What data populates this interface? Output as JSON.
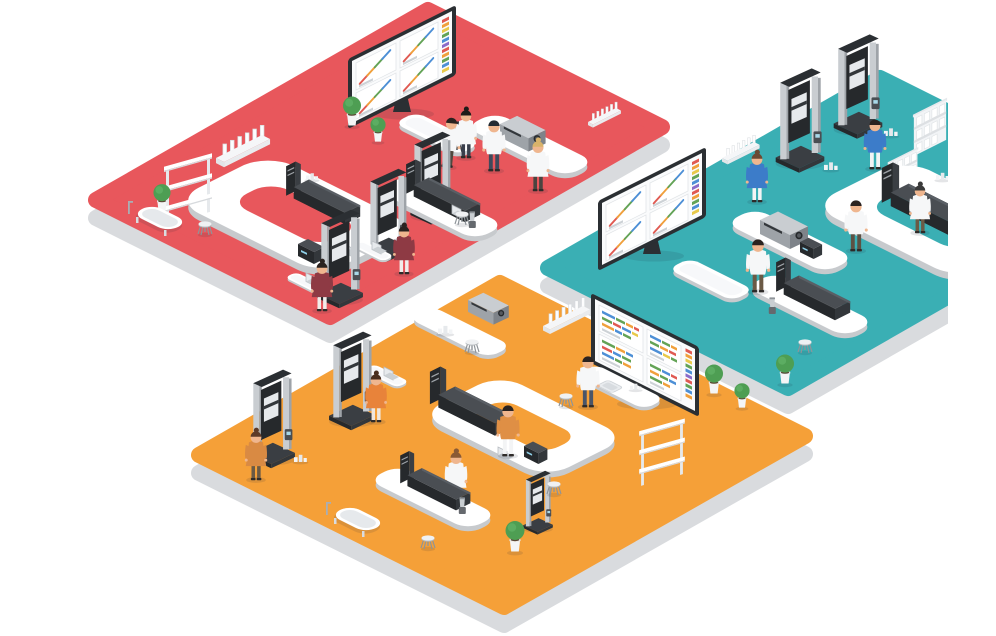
{
  "scene": {
    "title": "Isometric laboratory rooms illustration",
    "subtitle": "Three color-coded testing laboratories with scientists, analysis machines and presentation screens",
    "background_color": "#FFFFFF",
    "style": "flat isometric vector illustration",
    "no_visible_text": true
  },
  "palette": {
    "floor_red": "#E8575C",
    "floor_teal": "#3AAFB4",
    "floor_orange": "#F5A038",
    "platform_side": "#D9DBDE",
    "bench_white": "#FFFFFF",
    "bench_shadow": "#C7CACD",
    "machine_dark": "#26292C",
    "machine_frame_gray": "#C9CDD1",
    "screen_frame": "#2B2F33",
    "screen_background": "#FAFBFC",
    "chart_red": "#E05A52",
    "chart_orange": "#F0A03C",
    "chart_yellow": "#E8C94A",
    "chart_green": "#63A356",
    "chart_blue": "#4D8FD6",
    "chart_purple": "#8B6CC9",
    "plant_green": "#4E9E53",
    "pot_white": "#F4F5F6",
    "skin": "#EFB68F",
    "lab_coat_white": "#F6F7F8",
    "shirt_blue": "#3C7CC9",
    "shirt_maroon": "#8E3A44",
    "shirt_orange": "#E8833A",
    "cast_shadow": "rgba(32,42,54,0.12)"
  },
  "platforms": [
    {
      "id": "red-lab",
      "label": "Red laboratory platform",
      "floor_color": "#E8575C",
      "position": "upper left",
      "equipment": [
        "wall presentation screen with four line-chart panels",
        "white side table",
        "test-tube rack",
        "benchtop spectrometer on straight bench",
        "small bottle rack",
        "U-shaped island workbench with chromatography analyzer, instrument box and laptop",
        "chromatography bench with laptop and mixer",
        "universal testing machine x3 with laptop desks",
        "open storage shelf",
        "laboratory tub sink",
        "potted plant x3",
        "lab stool x2"
      ],
      "people": [
        {
          "outfit": "white lab coat",
          "activity": "leaning on side table"
        },
        {
          "outfit": "white lab coat",
          "activity": "recording with tripod-mounted camera"
        },
        {
          "outfit": "white lab coat",
          "activity": "standing in walkway"
        },
        {
          "outfit": "white lab coat, blonde hair",
          "activity": "standing at spectrometer bench"
        },
        {
          "outfit": "maroon top",
          "activity": "operating left testing machine"
        },
        {
          "outfit": "maroon top",
          "activity": "operating right testing machine"
        }
      ]
    },
    {
      "id": "teal-lab",
      "label": "Teal laboratory platform",
      "floor_color": "#3AAFB4",
      "position": "upper right, artwork clipped at right edge",
      "equipment": [
        "universal testing machine x2 with sample stands",
        "bottle storage shelf x2",
        "small bottle rack",
        "U-shaped island workbench with chromatography analyzer",
        "spectrometer bench with instrument box",
        "low white table",
        "chromatography bench with mixer",
        "wall presentation screen with four line-chart panels",
        "lab stool",
        "potted plant"
      ],
      "people": [
        {
          "outfit": "blue sweater, white trousers",
          "activity": "standing at testing machine"
        },
        {
          "outfit": "blue sweater, white trousers",
          "activity": "operating testing machine"
        },
        {
          "outfit": "white lab coat",
          "activity": "walking between benches"
        },
        {
          "outfit": "white lab coat",
          "activity": "standing at spectrometer bench"
        },
        {
          "outfit": "white lab coat",
          "activity": "working at island workbench"
        }
      ]
    },
    {
      "id": "orange-lab",
      "label": "Orange laboratory platform",
      "floor_color": "#F5A038",
      "position": "lower center",
      "equipment": [
        "wall presentation screen with horizontal bar-chart panels",
        "test-tube rack",
        "upper bench with spectrometer and bottle samples",
        "laptop desk",
        "universal testing machine x2 and compact tester",
        "U-shaped island workbench with chromatography analyzer, laptop and instrument box",
        "sink bench",
        "chromatography bench with mixer",
        "open storage shelf",
        "laboratory tub sink",
        "potted plant x3",
        "lab stool x4"
      ],
      "people": [
        {
          "outfit": "orange top",
          "activity": "working at left testing machine"
        },
        {
          "outfit": "orange top",
          "activity": "operating testing machine with laptop"
        },
        {
          "outfit": "tan shirt",
          "activity": "standing at island workbench"
        },
        {
          "outfit": "white lab coat",
          "activity": "working at sink bench"
        },
        {
          "outfit": "white lab coat, red skirt",
          "activity": "working at island workbench"
        }
      ]
    }
  ],
  "screens": [
    {
      "id": "screen-red",
      "location": "red platform, upper left",
      "panels": "2x2 grid of diagonal multi-color line charts with gray caption bars",
      "legend": "vertical rainbow bar column on right side",
      "series_colors": [
        "#E05A52",
        "#F0A03C",
        "#63A356",
        "#4D8FD6"
      ]
    },
    {
      "id": "screen-middle",
      "location": "left corner of teal platform",
      "panels": "2x2 grid of diagonal multi-color line charts with gray caption bars",
      "legend": "vertical rainbow bar column on right side",
      "series_colors": [
        "#E05A52",
        "#F0A03C",
        "#63A356",
        "#4D8FD6"
      ]
    },
    {
      "id": "screen-orange",
      "location": "orange platform, near top edge",
      "panels": "four panels of horizontal multi-color segment bars with gray caption bars",
      "legend": "vertical rainbow bar column on right side",
      "series_colors": [
        "#4D8FD6",
        "#63A356",
        "#F0A03C",
        "#E05A52",
        "#E8C94A"
      ]
    }
  ],
  "counts": {
    "platforms": 3,
    "people": 16,
    "testing_machines": 8,
    "presentation_screens": 3,
    "potted_plants": 7,
    "stools": 7
  }
}
